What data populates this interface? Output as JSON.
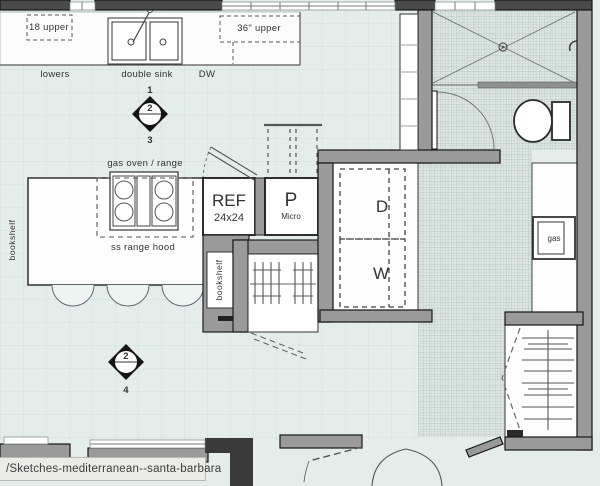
{
  "status_bar": {
    "text": "/Sketches-mediterranean--santa-barbara"
  },
  "kitchen": {
    "upper_left": "18 upper",
    "upper_right": "36\" upper",
    "lowers": "lowers",
    "double_sink": "double sink",
    "dishwasher": "DW",
    "gas_range": "gas oven / range",
    "range_hood": "ss range hood",
    "island_bookshelf": "bookshelf",
    "fridge": "REF",
    "fridge_size": "24x24",
    "pantry": "P",
    "pantry_micro": "Micro",
    "cabinet_bookshelf": "bookshelf"
  },
  "laundry": {
    "dryer": "D",
    "washer": "W"
  },
  "utility": {
    "gas": "gas"
  },
  "markers": {
    "a": {
      "top": "1",
      "face": "2",
      "bottom": "3"
    },
    "b": {
      "face": "2",
      "bottom": "4"
    }
  },
  "colors": {
    "background": "#e4ede9",
    "wall": "#9a9a9a",
    "wall_dark": "#4a4a4a",
    "ink": "#333333",
    "tile_line": "#aebfba"
  }
}
